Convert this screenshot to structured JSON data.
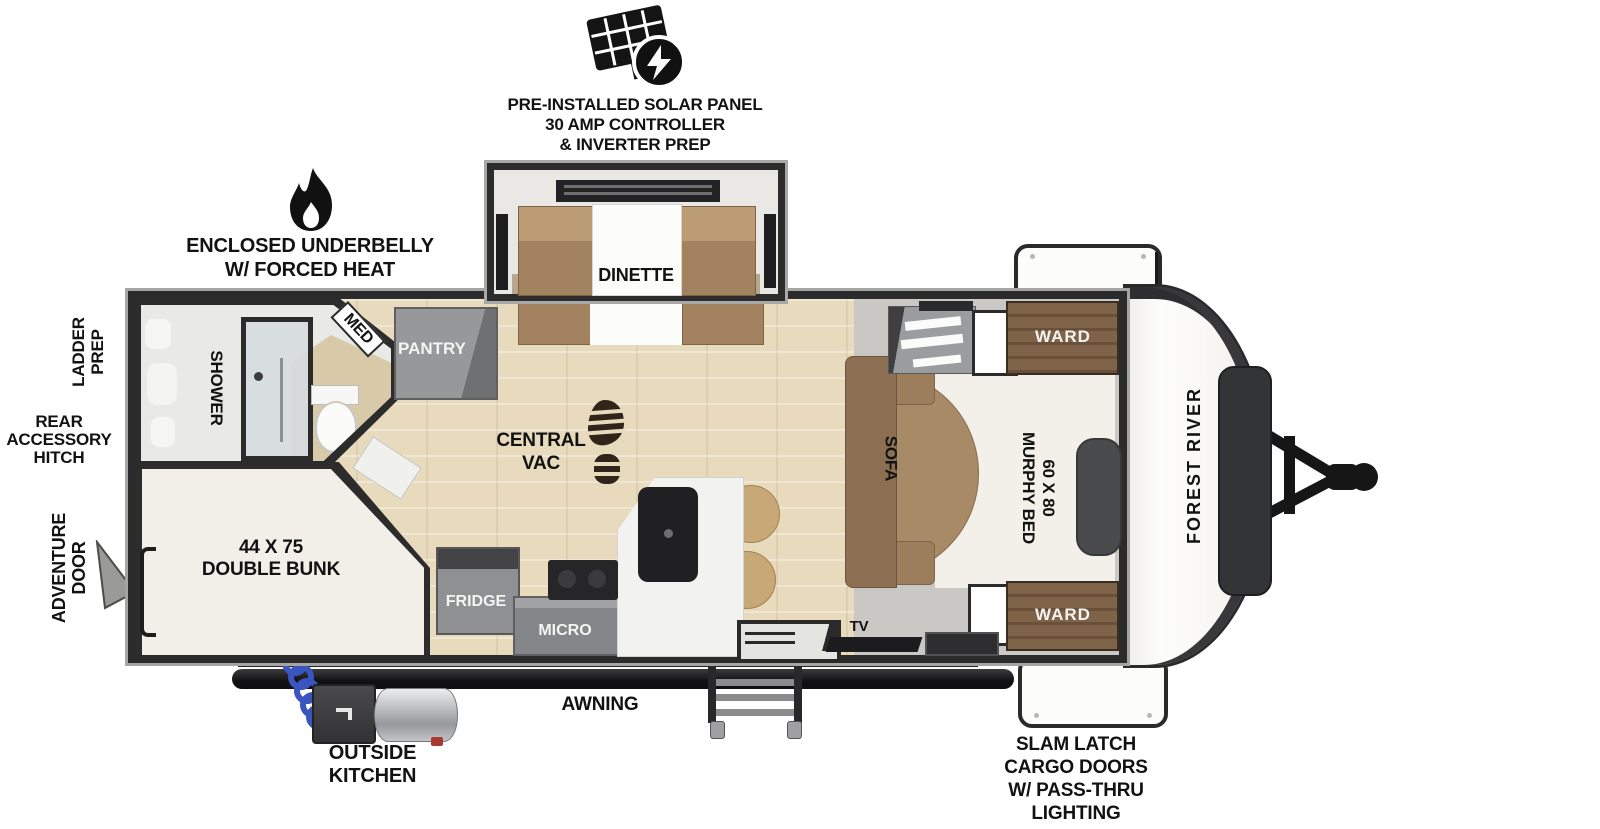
{
  "brand": "FOREST RIVER",
  "callouts": {
    "solar": [
      "PRE-INSTALLED SOLAR PANEL",
      "30 AMP CONTROLLER",
      "& INVERTER PREP"
    ],
    "underbelly": [
      "ENCLOSED UNDERBELLY",
      "W/ FORCED HEAT"
    ],
    "ladder_prep": [
      "LADDER",
      "PREP"
    ],
    "rear_hitch": [
      "REAR",
      "ACCESSORY",
      "HITCH"
    ],
    "adventure_door": [
      "ADVENTURE",
      "DOOR"
    ],
    "awning": "AWNING",
    "outside_kitchen": [
      "OUTSIDE",
      "KITCHEN"
    ],
    "slam_latch": [
      "SLAM LATCH",
      "CARGO DOORS",
      "W/ PASS-THRU",
      "LIGHTING"
    ]
  },
  "rooms": {
    "dinette": "DINETTE",
    "med": "MED",
    "pantry": "PANTRY",
    "shower": "SHOWER",
    "central_vac": [
      "CENTRAL",
      "VAC"
    ],
    "double_bunk": [
      "44 X 75",
      "DOUBLE BUNK"
    ],
    "fridge": "FRIDGE",
    "micro": "MICRO",
    "ohc": "OHC",
    "sofa": "SOFA",
    "murphy_bed": [
      "60 X 80",
      "MURPHY BED"
    ],
    "ward_top": "WARD",
    "ward_bottom": "WARD",
    "tv": "TV"
  },
  "colors": {
    "wall": "#2b2b2b",
    "wood_floor": "#e7dabd",
    "cabinet_gray": "#8f9092",
    "sofa_brown": "#a98a67",
    "ward_wood": "#7c6147",
    "bed_white": "#f2f0e9",
    "hose_blue": "#3a55bd",
    "callout_text": "#121212"
  }
}
